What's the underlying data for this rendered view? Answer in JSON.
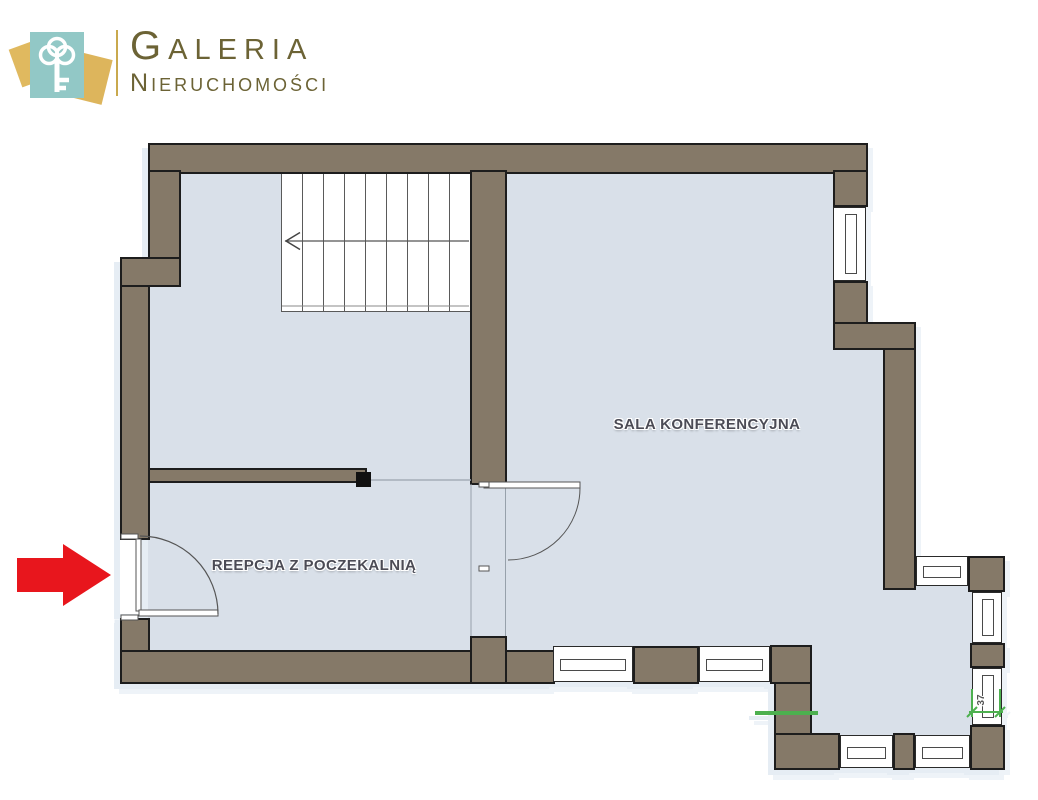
{
  "brand": {
    "name_line1": "GALERIA",
    "name_line2": "NIERUCHOMOŚCI",
    "icon": "key-icon",
    "colors": {
      "teal": "#92c8c6",
      "gold": "#ddb55c",
      "text_olive": "#6c6335"
    }
  },
  "floorplan": {
    "rooms": [
      {
        "id": "sala-konferencyjna",
        "label": "SALA KONFERENCYJNA"
      },
      {
        "id": "recepcja-z-poczekalnia",
        "label": "REEPCJA Z POCZEKALNIĄ"
      }
    ],
    "dimensions": [
      {
        "value": "37",
        "location": "right-bay-window",
        "color": "#4db04f"
      }
    ],
    "entrance_marker": "red-arrow",
    "features": [
      "stairs",
      "entrance-door",
      "interior-door",
      "windows"
    ],
    "colors": {
      "wall": "#857968",
      "wall_outline": "#1d1d1d",
      "floor": "#d9e0e9",
      "arrow_red": "#e8161d",
      "dimension_green": "#4db04f"
    }
  }
}
